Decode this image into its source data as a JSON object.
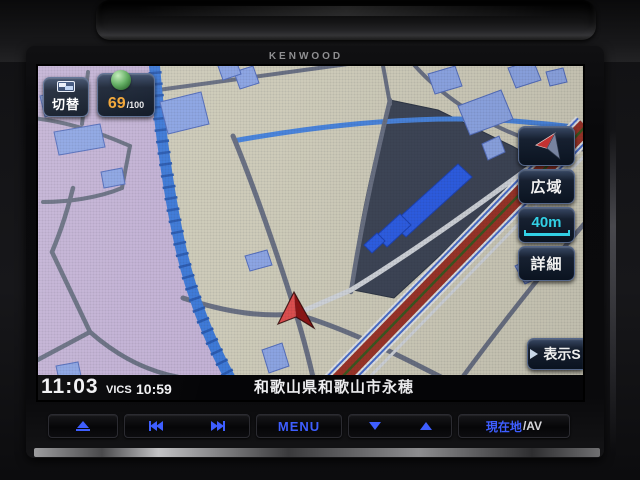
{
  "device": {
    "brand_label": "KENWOOD"
  },
  "map_screen": {
    "switch_button_label": "切替",
    "eco_score": {
      "value": "69",
      "max": "/100"
    },
    "right_panel": {
      "wide_area_label": "広域",
      "scale_label": "40m",
      "detail_label": "詳細"
    },
    "display_s_label": "表示S",
    "partial_map_label": "ーナ",
    "status_bar": {
      "clock": "11:03",
      "vics_label": "VICS",
      "vics_time": "10:59",
      "location": "和歌山県和歌山市永穂"
    },
    "colors": {
      "urban_area": "#c7b6d9",
      "land_base": "#d2cfbd",
      "facility_lot": "#3e4657",
      "building_blue": "#8fa8e8",
      "highlight_building": "#2e5fe8",
      "water_blue": "#3b79d8",
      "major_road_red": "#9e3428",
      "road_median_green": "#3c5a20",
      "scale_cyan": "#35dcf2",
      "eco_orange": "#f2a432"
    }
  },
  "hard_keys": {
    "menu_label": "MENU",
    "current_location_label": "現在地",
    "av_label": "/AV",
    "key_glyph_color": "#3e5eff"
  }
}
